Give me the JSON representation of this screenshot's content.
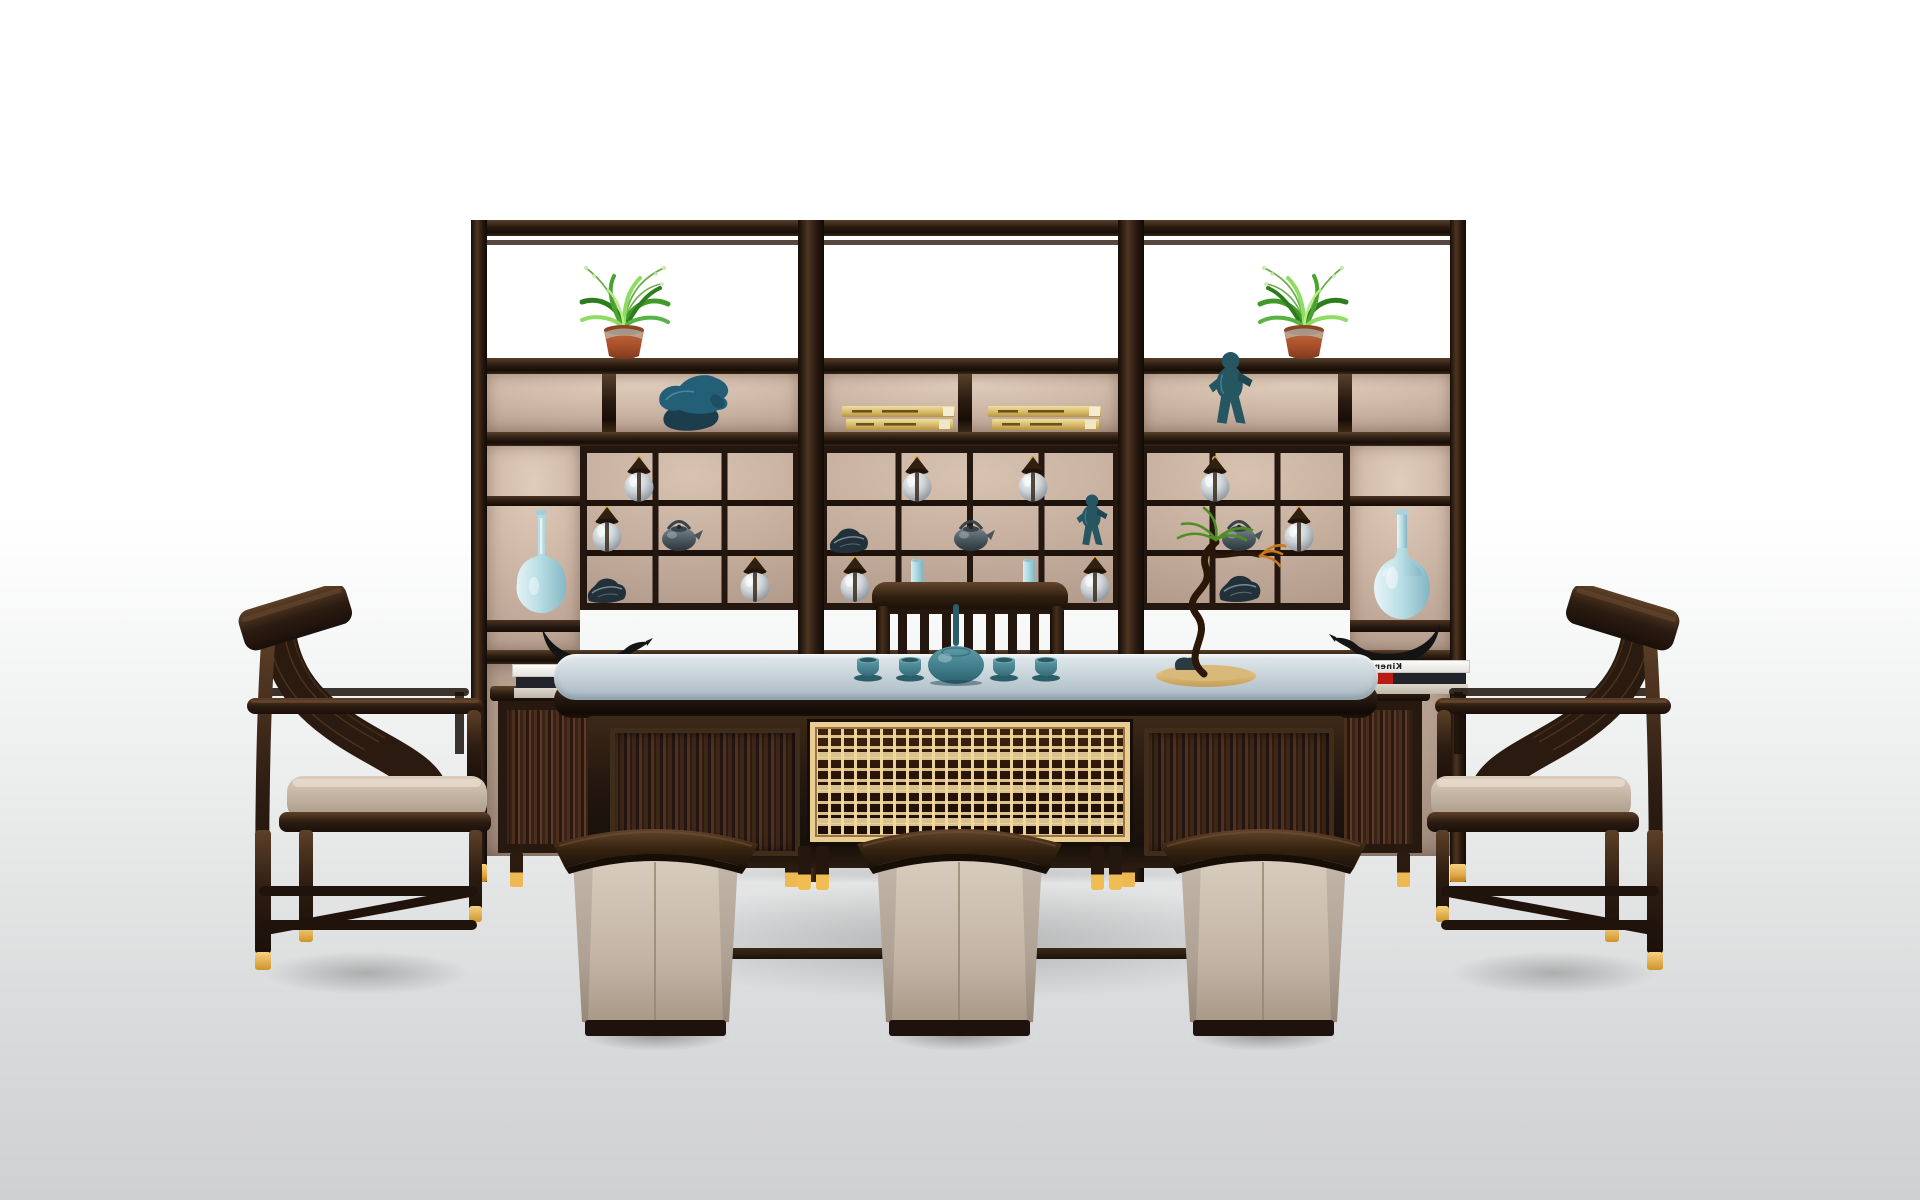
{
  "scene": {
    "book_title": "Kinemathek"
  },
  "palette": {
    "wood_dark": "#241710",
    "wood_mid": "#3e2a1b",
    "wood_light": "#6b4a30",
    "panel_tan": "#c9b2a2",
    "panel_tan_light": "#e1cdbb",
    "panel_tan_dark": "#b29a8a",
    "tabletop_blue": "#b9c6ce",
    "tabletop_blue_light": "#dce4e8",
    "teal": "#44828f",
    "teal_dark": "#2c5e6a",
    "light_blue": "#bfe0e8",
    "light_blue_deep": "#8cc3d2",
    "gold": "#e5a93f",
    "gold_light": "#f4cf7d",
    "lattice_gold": "#ecd096",
    "leather": "#c9bbac",
    "cushion": "#cdbdaa",
    "floor_gray": "#d3d4d6",
    "glass_light": "#eef1f3",
    "figure_teal": "#265663",
    "bird_black": "#161616",
    "terracotta": "#b05c36",
    "plant_green": "#4aa32e"
  },
  "objects": [
    {
      "type": "potted-plant",
      "x": 544,
      "y": 246,
      "w": 160,
      "h": 116,
      "layer": "cabinet"
    },
    {
      "type": "potted-plant",
      "x": 1224,
      "y": 246,
      "w": 160,
      "h": 116,
      "layer": "cabinet",
      "flip": true
    },
    {
      "type": "bull-figurine",
      "x": 650,
      "y": 366,
      "w": 84,
      "h": 66,
      "layer": "cabinet"
    },
    {
      "type": "child-figurine",
      "x": 1202,
      "y": 350,
      "w": 60,
      "h": 82,
      "layer": "cabinet"
    },
    {
      "type": "gold-books",
      "x": 840,
      "y": 404,
      "w": 118,
      "h": 28,
      "layer": "cabinet"
    },
    {
      "type": "gold-books",
      "x": 986,
      "y": 404,
      "w": 118,
      "h": 28,
      "layer": "cabinet"
    },
    {
      "type": "lantern-jar",
      "x": 620,
      "y": 455,
      "w": 38,
      "h": 48,
      "layer": "cabinet"
    },
    {
      "type": "lantern-jar",
      "x": 588,
      "y": 505,
      "w": 38,
      "h": 48,
      "layer": "cabinet"
    },
    {
      "type": "lantern-jar",
      "x": 736,
      "y": 555,
      "w": 38,
      "h": 48,
      "layer": "cabinet"
    },
    {
      "type": "lantern-jar",
      "x": 898,
      "y": 455,
      "w": 38,
      "h": 48,
      "layer": "cabinet"
    },
    {
      "type": "lantern-jar",
      "x": 1014,
      "y": 455,
      "w": 38,
      "h": 48,
      "layer": "cabinet"
    },
    {
      "type": "lantern-jar",
      "x": 836,
      "y": 555,
      "w": 38,
      "h": 48,
      "layer": "cabinet"
    },
    {
      "type": "lantern-jar",
      "x": 1076,
      "y": 555,
      "w": 38,
      "h": 48,
      "layer": "cabinet"
    },
    {
      "type": "lantern-jar",
      "x": 1196,
      "y": 455,
      "w": 38,
      "h": 48,
      "layer": "cabinet"
    },
    {
      "type": "lantern-jar",
      "x": 1280,
      "y": 505,
      "w": 38,
      "h": 48,
      "layer": "cabinet"
    },
    {
      "type": "teapot",
      "x": 656,
      "y": 517,
      "w": 48,
      "h": 36,
      "layer": "cabinet"
    },
    {
      "type": "teapot",
      "x": 948,
      "y": 517,
      "w": 48,
      "h": 36,
      "layer": "cabinet"
    },
    {
      "type": "teapot",
      "x": 1216,
      "y": 517,
      "w": 48,
      "h": 36,
      "layer": "cabinet"
    },
    {
      "type": "rock-ornament",
      "x": 584,
      "y": 575,
      "w": 46,
      "h": 28,
      "layer": "cabinet"
    },
    {
      "type": "rock-ornament",
      "x": 826,
      "y": 525,
      "w": 46,
      "h": 28,
      "layer": "cabinet"
    },
    {
      "type": "rock-ornament",
      "x": 1215,
      "y": 572,
      "w": 50,
      "h": 30,
      "layer": "cabinet"
    },
    {
      "type": "child-figurine",
      "x": 1072,
      "y": 493,
      "w": 42,
      "h": 58,
      "layer": "cabinet"
    },
    {
      "type": "cylinder-vase",
      "x": 910,
      "y": 558,
      "w": 14,
      "h": 46,
      "layer": "cabinet"
    },
    {
      "type": "cylinder-vase",
      "x": 1022,
      "y": 558,
      "w": 14,
      "h": 46,
      "layer": "cabinet"
    },
    {
      "type": "gourd-vase-tall",
      "x": 514,
      "y": 510,
      "w": 54,
      "h": 112,
      "layer": "cabinet"
    },
    {
      "type": "gourd-vase-round",
      "x": 1372,
      "y": 508,
      "w": 60,
      "h": 114,
      "layer": "cabinet"
    },
    {
      "type": "bird-figurine",
      "x": 532,
      "y": 622,
      "w": 122,
      "h": 46,
      "layer": "sideboard"
    },
    {
      "type": "white-books",
      "x": 512,
      "y": 664,
      "w": 136,
      "h": 38,
      "layer": "sideboard"
    },
    {
      "type": "bird-figurine",
      "x": 1328,
      "y": 618,
      "w": 122,
      "h": 46,
      "layer": "sideboard",
      "flip": true
    },
    {
      "type": "white-books",
      "x": 1334,
      "y": 660,
      "w": 136,
      "h": 38,
      "layer": "sideboard",
      "flip": true
    },
    {
      "type": "tea-teapot",
      "x": 924,
      "y": 604,
      "w": 64,
      "h": 82,
      "layer": "tabletop"
    },
    {
      "type": "teacup",
      "x": 852,
      "y": 656,
      "w": 32,
      "h": 26,
      "layer": "tabletop"
    },
    {
      "type": "teacup",
      "x": 894,
      "y": 656,
      "w": 32,
      "h": 26,
      "layer": "tabletop"
    },
    {
      "type": "teacup",
      "x": 988,
      "y": 656,
      "w": 32,
      "h": 26,
      "layer": "tabletop"
    },
    {
      "type": "teacup",
      "x": 1030,
      "y": 656,
      "w": 32,
      "h": 26,
      "layer": "tabletop"
    },
    {
      "type": "bonsai",
      "x": 1120,
      "y": 500,
      "w": 170,
      "h": 190,
      "layer": "tabletop"
    },
    {
      "type": "armchair",
      "x": 233,
      "y": 586,
      "w": 260,
      "h": 400,
      "layer": "chairs"
    },
    {
      "type": "armchair",
      "x": 1425,
      "y": 586,
      "w": 260,
      "h": 400,
      "layer": "chairs",
      "flip": true
    },
    {
      "type": "stool",
      "x": 549,
      "y": 810,
      "w": 213,
      "h": 226,
      "layer": "stools"
    },
    {
      "type": "stool",
      "x": 853,
      "y": 810,
      "w": 213,
      "h": 226,
      "layer": "stools"
    },
    {
      "type": "stool",
      "x": 1157,
      "y": 810,
      "w": 213,
      "h": 226,
      "layer": "stools"
    }
  ]
}
